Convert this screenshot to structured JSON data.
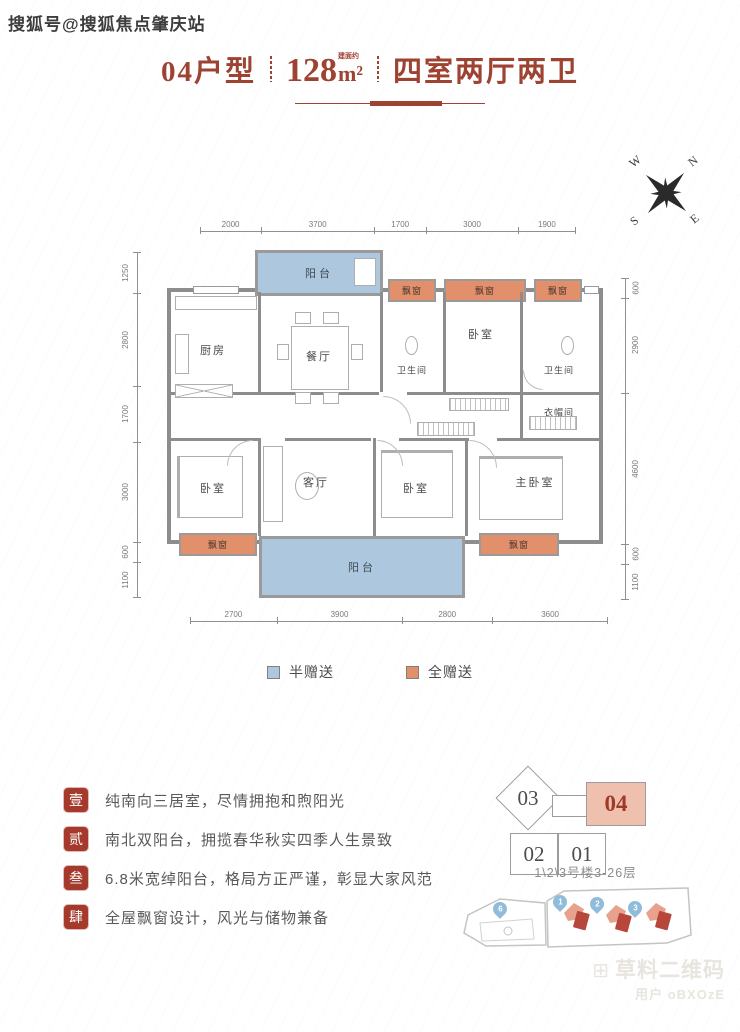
{
  "watermarks": {
    "sohu": "搜狐号@搜狐焦点肇庆站",
    "qr_brand": "草料二维码",
    "qr_user": "用户 oBXOzE"
  },
  "title": {
    "unit": "04户型",
    "area_value": "128",
    "area_note": "建面约",
    "area_unit": "m²",
    "rooms": "四室两厅两卫"
  },
  "compass": {
    "n": "N",
    "e": "E",
    "s": "S",
    "w": "W"
  },
  "plan": {
    "rooms": {
      "balcony_top": "阳台",
      "kitchen": "厨房",
      "dining": "餐厅",
      "bay_top_1": "飘窗",
      "bay_top_2": "飘窗",
      "bay_top_3": "飘窗",
      "bath_1": "卫生间",
      "bedroom_top": "卧室",
      "bath_2": "卫生间",
      "cloakroom": "衣帽间",
      "bedroom_left": "卧室",
      "living": "客厅",
      "bedroom_mid": "卧室",
      "master_bedroom": "主卧室",
      "bay_bottom_left": "飘窗",
      "balcony_bottom": "阳台",
      "bay_bottom_right": "飘窗"
    },
    "dims_top": [
      "2000",
      "3700",
      "1700",
      "3000",
      "1900"
    ],
    "dims_bottom": [
      "2700",
      "3900",
      "2800",
      "3600"
    ],
    "dims_left": [
      "1250",
      "2800",
      "1700",
      "3000",
      "600",
      "1100"
    ],
    "dims_right": [
      "600",
      "2900",
      "4600",
      "600",
      "1100"
    ]
  },
  "legend": {
    "half": {
      "label": "半赠送",
      "color": "#adc8de"
    },
    "full": {
      "label": "全赠送",
      "color": "#e2906b"
    }
  },
  "features": [
    {
      "num": "壹",
      "text": "纯南向三居室，尽情拥抱和煦阳光"
    },
    {
      "num": "贰",
      "text": "南北双阳台，拥揽春华秋实四季人生景致"
    },
    {
      "num": "叁",
      "text": "6.8米宽绰阳台，格局方正严谨，彰显大家风范"
    },
    {
      "num": "肆",
      "text": "全屋飘窗设计，风光与储物兼备"
    }
  ],
  "location": {
    "unit_03": "03",
    "unit_04": "04",
    "unit_02": "02",
    "unit_01": "01",
    "caption": "1\\2\\3号楼3-26层",
    "pins": [
      "6",
      "1",
      "2",
      "3"
    ]
  },
  "colors": {
    "accent_red": "#9e4232",
    "seal_red": "#a53a2c",
    "half_gift_blue": "#adc8de",
    "full_gift_orange": "#e2906b",
    "wall_gray": "#8d8d8d",
    "unit_highlight": "#f0c0ae"
  }
}
